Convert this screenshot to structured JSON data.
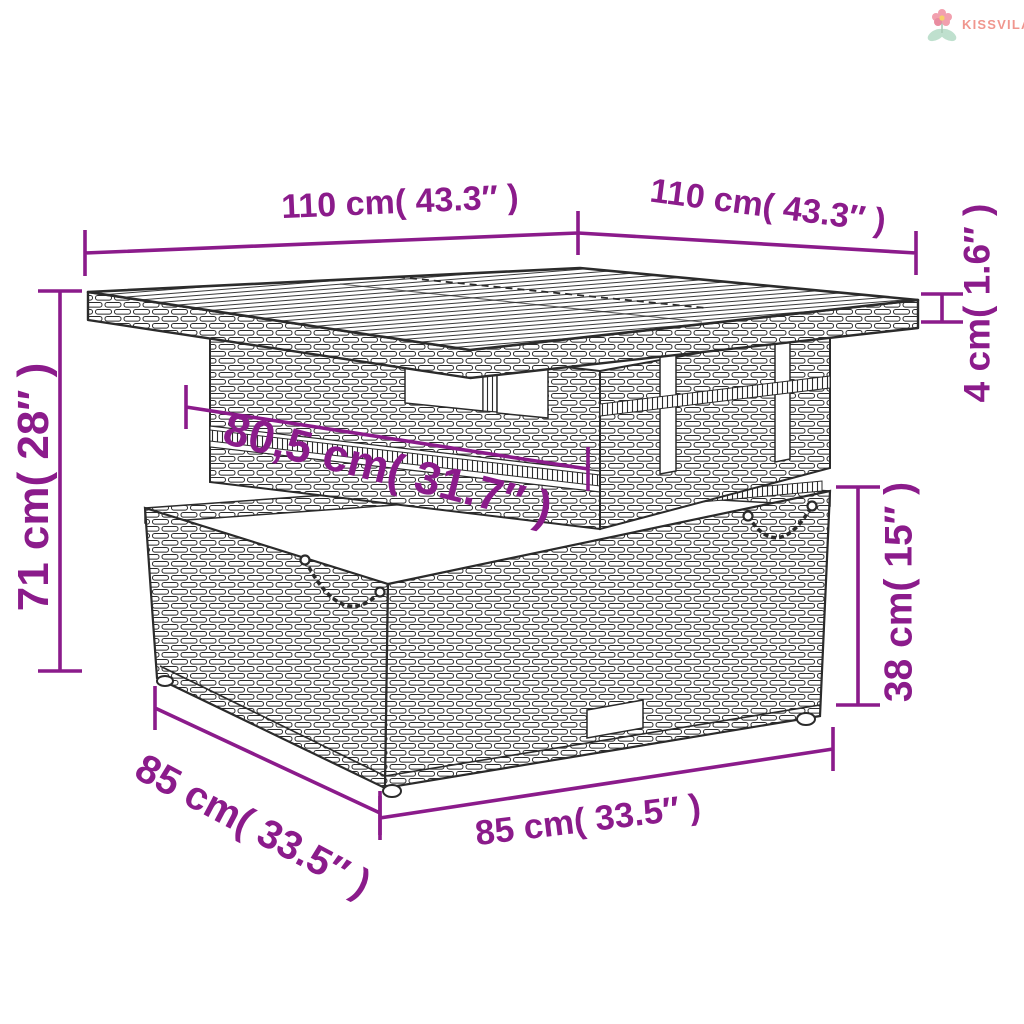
{
  "brand": {
    "name": "KISSVILÁG",
    "text_color": "#F0968E",
    "flower_petal_color": "#F2A0AE",
    "flower_center_color": "#F7D06B",
    "flower_leaf_color": "#BFE0CE"
  },
  "diagram": {
    "dimension_color": "#8B1B8B",
    "line_art_color": "#2b2b2b",
    "background_color": "#ffffff"
  },
  "dimensions": {
    "top_width_left": "110 cm( 43.3″ )",
    "top_width_right": "110 cm( 43.3″ )",
    "total_height": "71 cm( 28″ )",
    "inner_top_width": "80,5 cm( 31.7″ )",
    "tabletop_thickness": "4 cm( 1.6″ )",
    "base_height": "38 cm( 15″ )",
    "base_depth": "85 cm( 33.5″ )",
    "base_width": "85 cm( 33.5″ )"
  }
}
